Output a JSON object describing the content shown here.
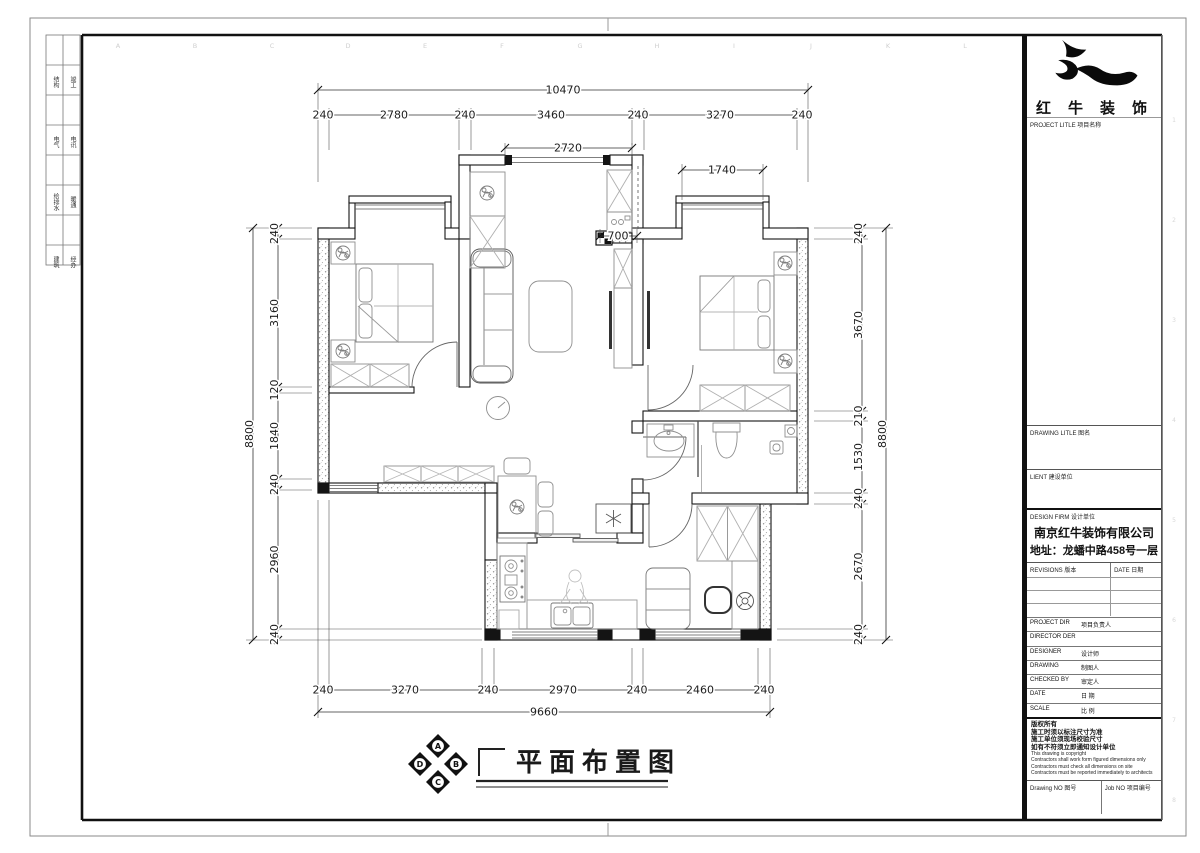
{
  "drawing_label": {
    "title": "平面布置图"
  },
  "compass": {
    "top": "A",
    "right": "B",
    "bottom": "C",
    "left": "D"
  },
  "dims": {
    "top_total": "10470",
    "top_segments": [
      "240",
      "2780",
      "240",
      "3460",
      "240",
      "3270",
      "240"
    ],
    "bottom_total": "9660",
    "bottom_segments": [
      "240",
      "3270",
      "240",
      "2970",
      "240",
      "2460",
      "240"
    ],
    "left_total": "8800",
    "left_segments": [
      "240",
      "3160",
      "120",
      "1840",
      "240",
      "2960",
      "240"
    ],
    "right_total": "8800",
    "right_segments": [
      "240",
      "3670",
      "210",
      "1530",
      "240",
      "2670",
      "240"
    ],
    "entry_width": "2720",
    "bedroom_window": "1740",
    "cabinet_depth": "700"
  },
  "frame": {
    "grid_letters": [
      "A",
      "B",
      "C",
      "D",
      "E",
      "F",
      "G",
      "H",
      "I",
      "J",
      "K",
      "L"
    ],
    "row_numbers": [
      "1",
      "2",
      "3",
      "4",
      "5",
      "6",
      "7",
      "8"
    ]
  },
  "signature_strip": {
    "rows": [
      {
        "a": "结构",
        "b": "竣工"
      },
      {
        "a": "电气",
        "b": "电讯"
      },
      {
        "a": "给排水",
        "b": "暖通"
      },
      {
        "a": "建筑",
        "b": "经办"
      }
    ]
  },
  "title_block": {
    "brand": "红牛装饰",
    "project_title_label": "PROJECT LITLE  项目名称",
    "drawing_title_label": "DRAWING LITLE  图名",
    "client_label": "LIENT  建设单位",
    "design_firm_label": "DESIGN FIRM  设计单位",
    "firm_name": "南京红牛装饰有限公司",
    "firm_address": "地址：龙蟠中路458号一层",
    "revisions_label": "REVISIONS  版本",
    "date_label": "DATE  日期",
    "staff_rows": [
      {
        "en": "PROJECT DIR",
        "zh": "项目负责人"
      },
      {
        "en": "DIRECTOR DER",
        "zh": ""
      },
      {
        "en": "DESIGNER",
        "zh": "设计师"
      },
      {
        "en": "DRAWING",
        "zh": "制图人"
      },
      {
        "en": "CHECKED BY",
        "zh": "审定人"
      },
      {
        "en": "DATE",
        "zh": "日  期"
      },
      {
        "en": "SCALE",
        "zh": "比  例"
      }
    ],
    "copyright_zh": [
      "版权所有",
      "施工时须以标注尺寸为准",
      "施工单位须现场校验尺寸",
      "如有不符须立即通知设计单位"
    ],
    "copyright_en": [
      "This drawing is copyright",
      "Contractors shall work form figured dimensions only",
      "Contractors must check all dimensions on site",
      "Contractors must be reported immediately to architects"
    ],
    "drawing_no_label": "Drawing NO  图号",
    "job_no_label": "Job NO 项目编号"
  }
}
